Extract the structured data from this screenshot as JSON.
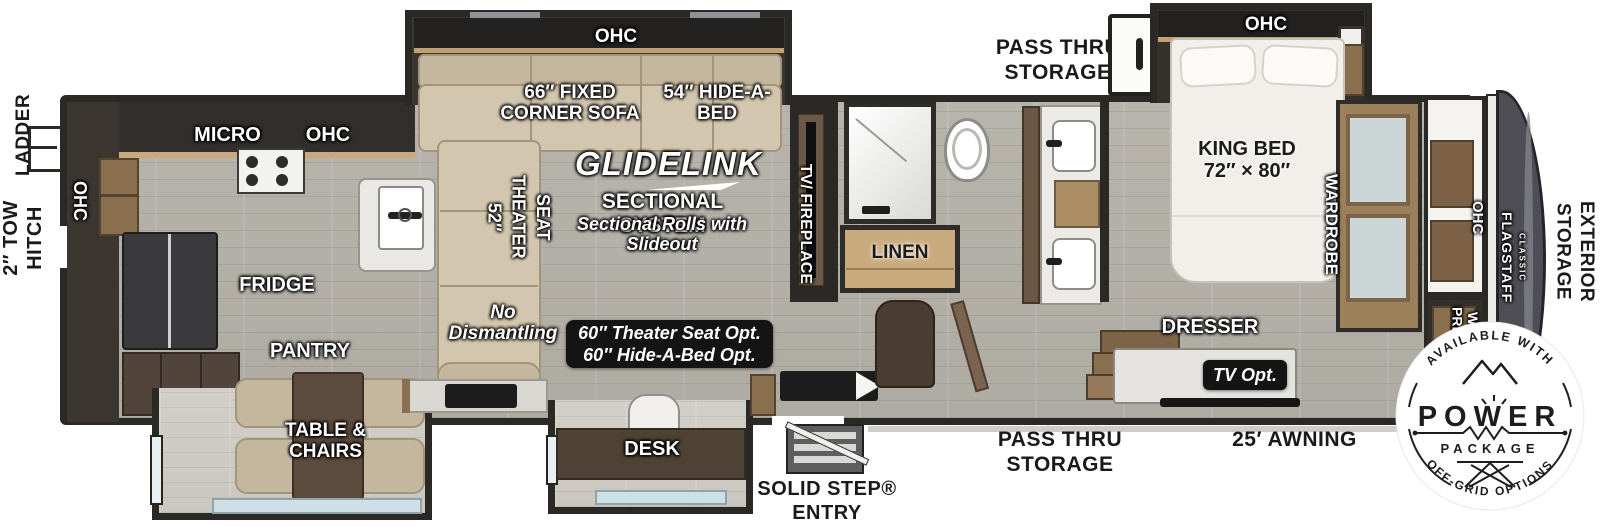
{
  "exterior": {
    "ladder": "LADDER",
    "tow_hitch": "2″ TOW HITCH",
    "pass_thru_top": "PASS THRU STORAGE",
    "pass_thru_bottom": "PASS THRU STORAGE",
    "entry": "SOLID STEP® ENTRY",
    "awning": "25′ AWNING",
    "exterior_storage": "EXTERIOR STORAGE"
  },
  "kitchen": {
    "ohc_rear": "OHC",
    "micro": "MICRO",
    "ohc_top": "OHC",
    "fridge": "FRIDGE",
    "pantry": "PANTRY",
    "table_chairs": "TABLE & CHAIRS"
  },
  "living": {
    "ohc": "OHC",
    "corner_sofa": "66″ FIXED CORNER SOFA",
    "hide_a_bed": "54″ HIDE-A-BED",
    "theater_seat": "52″ THEATER SEAT",
    "tv_fireplace": "TV/ FIREPLACE",
    "desk": "DESK",
    "no_dismantling": "No Dismantling",
    "glidelink": {
      "brand": "GLIDELINK",
      "system": "SECTIONAL SYSTEM",
      "note": "Sectional Rolls with Slideout"
    },
    "options_badge": {
      "line1": "60″ Theater Seat Opt.",
      "line2": "60″ Hide-A-Bed Opt."
    }
  },
  "bath": {
    "linen": "LINEN"
  },
  "bedroom": {
    "ohc": "OHC",
    "king_bed": "KING BED 72″ × 80″",
    "wardrobe": "WARDROBE",
    "dresser": "DRESSER",
    "tv_opt": "TV Opt.",
    "ohc_front": "OHC",
    "wd_prep": "W/D PREP"
  },
  "brand": {
    "name": "FLAGSTAFF",
    "series": "CLASSIC"
  },
  "power_badge": {
    "top_arc": "AVAILABLE WITH",
    "word": "POWER",
    "package": "PACKAGE",
    "bottom_arc": "OFF-GRID OPTIONS"
  },
  "colors": {
    "wall": "#2b2926",
    "floor": "#b7b4ac",
    "slideout_floor": "#d2cfc8",
    "wood_light": "#c9aa7d",
    "wood_mid": "#8a6f4f",
    "cabinet_dark": "#54453a",
    "sofa": "#d2c6ae",
    "badge_bg": "#141414",
    "front_cap": "#4e4e54"
  }
}
